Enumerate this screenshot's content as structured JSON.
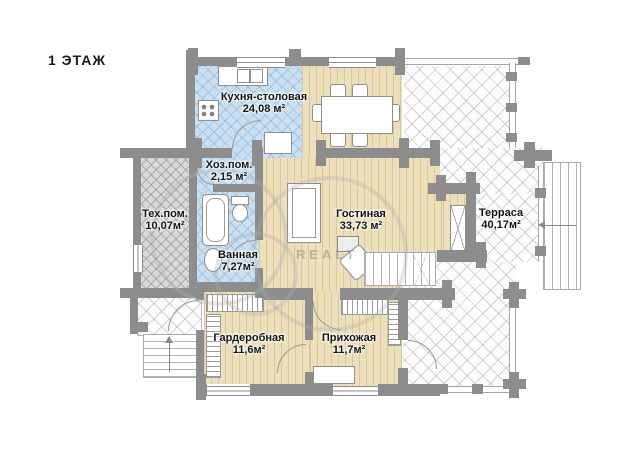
{
  "title": "1 ЭТАЖ",
  "watermark": "REALT",
  "rooms": [
    {
      "id": "kitchen",
      "name": "Кухня-столовая",
      "area": "24,08 м²"
    },
    {
      "id": "utility",
      "name": "Хоз.пом.",
      "area": "2,15 м²"
    },
    {
      "id": "tech",
      "name": "Тех.пом.",
      "area": "10,07м²"
    },
    {
      "id": "bath",
      "name": "Ванная",
      "area": "7,27м²"
    },
    {
      "id": "living",
      "name": "Гостиная",
      "area": "33,73 м²"
    },
    {
      "id": "terrace",
      "name": "Терраса",
      "area": "40,17м²"
    },
    {
      "id": "wardrobe",
      "name": "Гардеробная",
      "area": "11,6м²"
    },
    {
      "id": "hall",
      "name": "Прихожая",
      "area": "11,7м²"
    }
  ],
  "colors": {
    "wall": "#8d8d8d",
    "wood_floor": "#ecdfb9",
    "wet_floor": "#c8e0f1",
    "tech_floor": "#d9d9d9",
    "terrace_floor": "#fcfcfc",
    "label_text": "#161616"
  }
}
